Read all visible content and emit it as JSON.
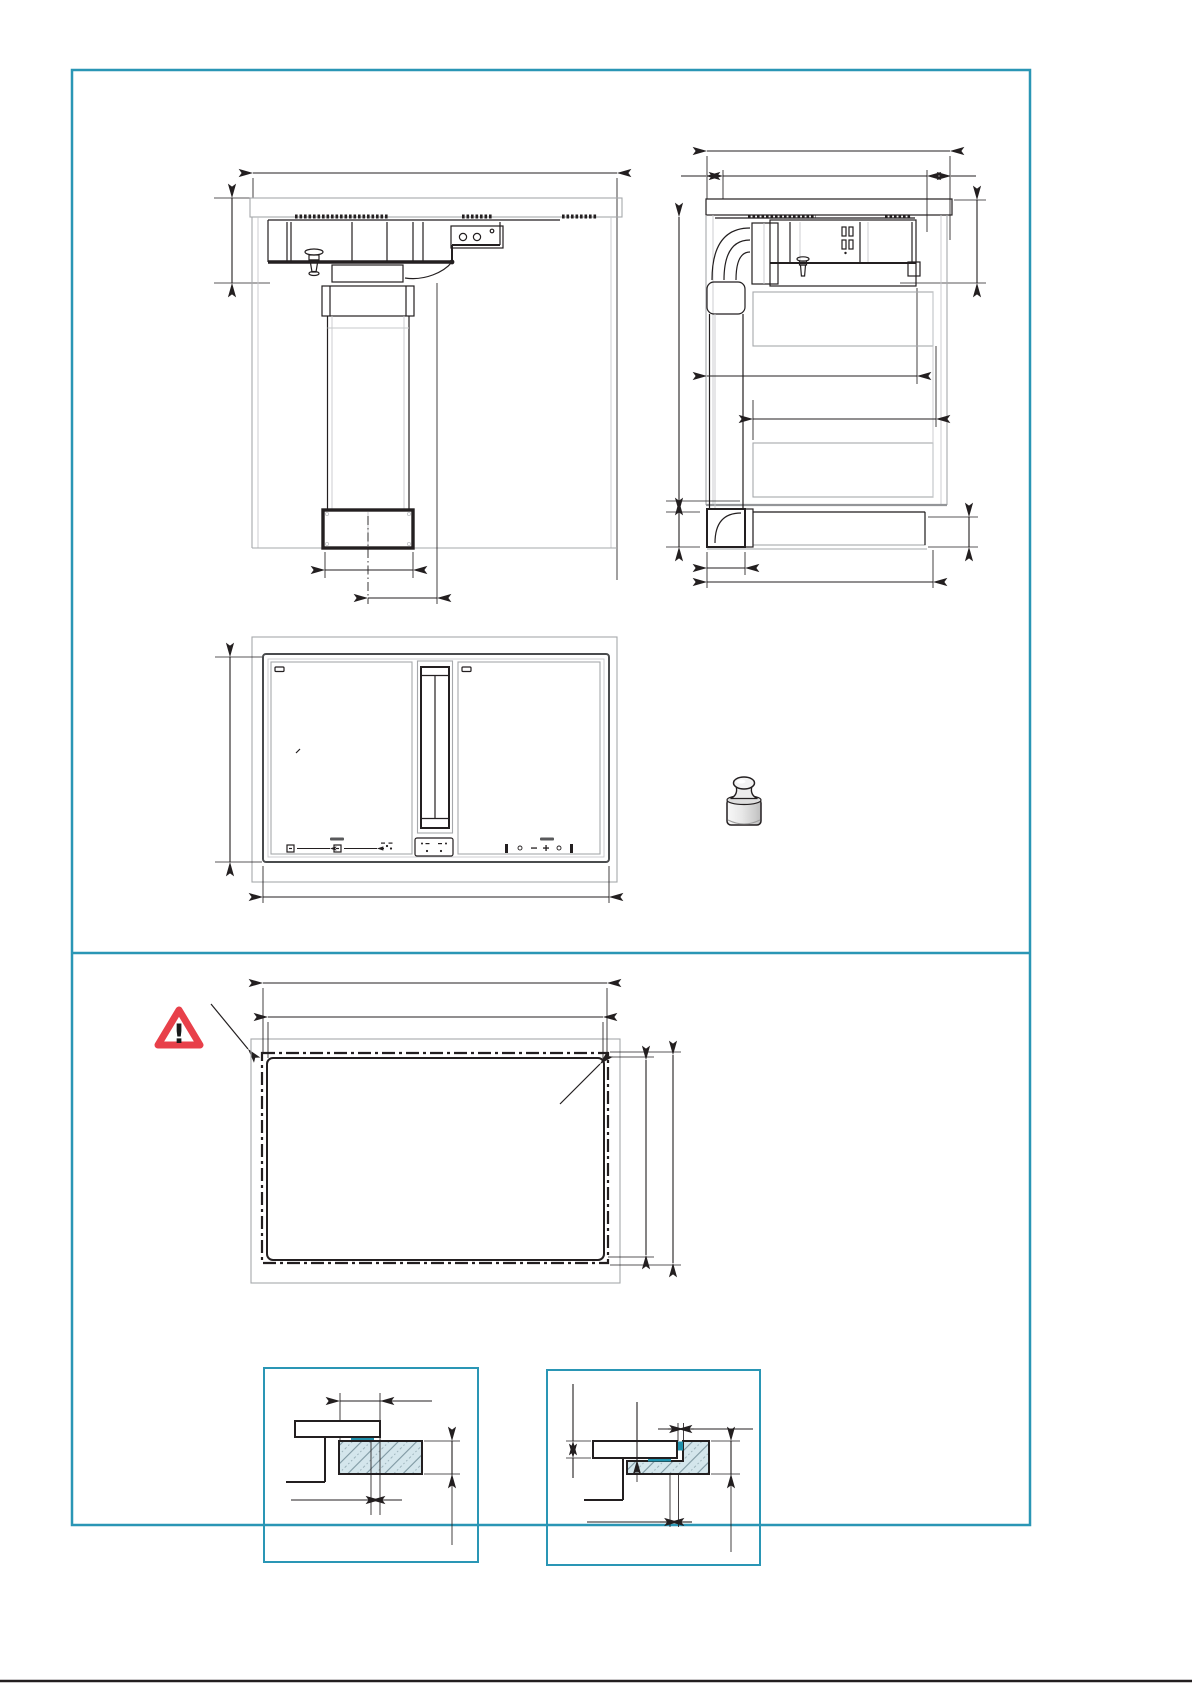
{
  "canvas": {
    "width": 1192,
    "height": 1685,
    "background": "#ffffff"
  },
  "frame": {
    "border_color": "#2a96b5",
    "divider_color": "#2a96b5",
    "detail_box_border_color": "#2a96b5",
    "bottom_rule_color": "#231f20"
  },
  "palette": {
    "line_black": "#231f20",
    "drawing_gray": "#a6a8ab",
    "mid_gray": "#939598",
    "hatch_fill": "#d4e6ec",
    "hatch_line": "#7e98a2",
    "seal_teal": "#1f91ac",
    "warning_red": "#e8404a",
    "weight_gray": "#e9e9e9"
  },
  "icons": {
    "warning": {
      "name": "warning-triangle-icon",
      "glyph": "!"
    },
    "weight": {
      "name": "calibration-weight-icon"
    }
  },
  "figures": [
    {
      "id": "fig-hob-front-section"
    },
    {
      "id": "fig-cabinet-side-section"
    },
    {
      "id": "fig-hob-plan-view"
    },
    {
      "id": "fig-worktop-cutout-plan"
    },
    {
      "id": "fig-detail-surface-mount"
    },
    {
      "id": "fig-detail-flush-mount"
    }
  ]
}
